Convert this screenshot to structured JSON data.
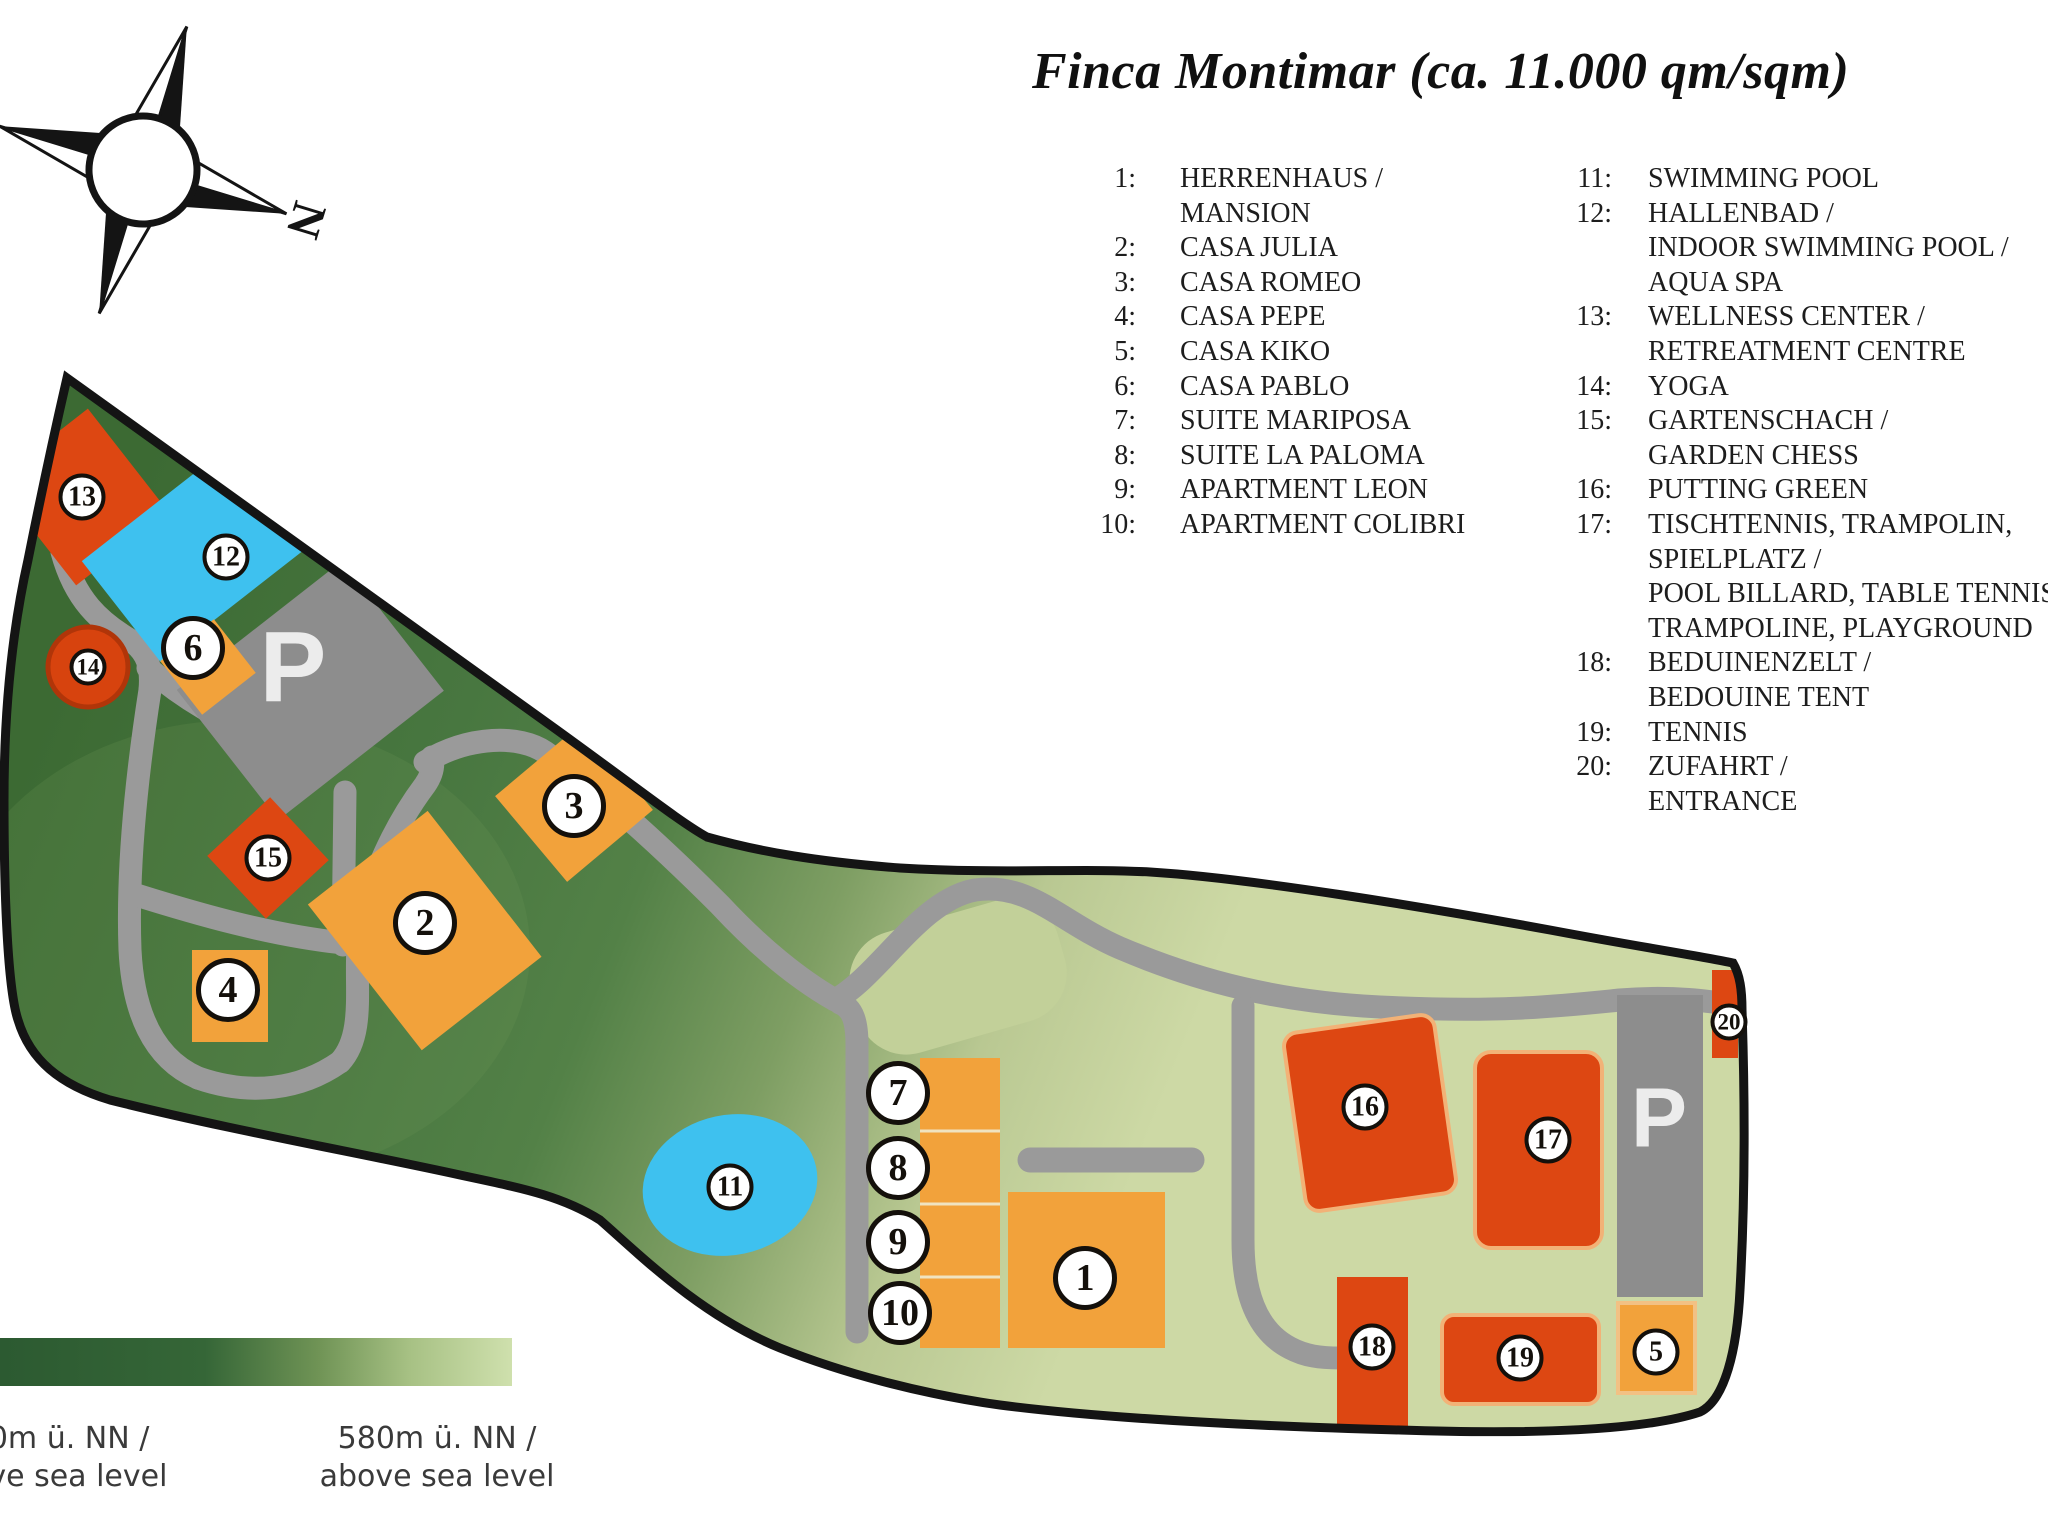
{
  "title": "Finca Montimar (ca. 11.000 qm/sqm)",
  "compass": {
    "north_label": "N"
  },
  "legend": {
    "col1": [
      {
        "num": "1:",
        "text": "HERRENHAUS /"
      },
      {
        "num": "",
        "text": "MANSION"
      },
      {
        "num": "2:",
        "text": "CASA JULIA"
      },
      {
        "num": "3:",
        "text": "CASA ROMEO"
      },
      {
        "num": "4:",
        "text": "CASA PEPE"
      },
      {
        "num": "5:",
        "text": "CASA KIKO"
      },
      {
        "num": "6:",
        "text": "CASA PABLO"
      },
      {
        "num": "7:",
        "text": "SUITE MARIPOSA"
      },
      {
        "num": "8:",
        "text": "SUITE LA PALOMA"
      },
      {
        "num": "9:",
        "text": "APARTMENT LEON"
      },
      {
        "num": "10:",
        "text": "APARTMENT COLIBRI"
      }
    ],
    "col2": [
      {
        "num": "11:",
        "text": "SWIMMING POOL"
      },
      {
        "num": "12:",
        "text": "HALLENBAD /"
      },
      {
        "num": "",
        "text": "INDOOR SWIMMING POOL /"
      },
      {
        "num": "",
        "text": "AQUA SPA"
      },
      {
        "num": "13:",
        "text": "WELLNESS CENTER /"
      },
      {
        "num": "",
        "text": "RETREATMENT CENTRE"
      },
      {
        "num": "14:",
        "text": "YOGA"
      },
      {
        "num": "15:",
        "text": "GARTENSCHACH /"
      },
      {
        "num": "",
        "text": "GARDEN CHESS"
      },
      {
        "num": "16:",
        "text": "PUTTING GREEN"
      },
      {
        "num": "17:",
        "text": "TISCHTENNIS, TRAMPOLIN,"
      },
      {
        "num": "",
        "text": "SPIELPLATZ /"
      },
      {
        "num": "",
        "text": "POOL BILLARD, TABLE TENNIS,"
      },
      {
        "num": "",
        "text": "TRAMPOLINE, PLAYGROUND"
      },
      {
        "num": "18:",
        "text": "BEDUINENZELT /"
      },
      {
        "num": "",
        "text": "BEDOUINE TENT"
      },
      {
        "num": "19:",
        "text": "TENNIS"
      },
      {
        "num": "20:",
        "text": "ZUFAHRT /"
      },
      {
        "num": "",
        "text": "ENTRANCE"
      }
    ]
  },
  "map": {
    "markers": [
      "1",
      "2",
      "3",
      "4",
      "5",
      "6",
      "7",
      "8",
      "9",
      "10",
      "11",
      "12",
      "13",
      "14",
      "15",
      "16",
      "17",
      "18",
      "19",
      "20"
    ],
    "parking_label": "P",
    "colors": {
      "land_dark_green": "#3c6a33",
      "land_light_green": "#cdd9a5",
      "building_orange": "#f2a23b",
      "building_red": "#dd4712",
      "water_blue": "#3ec1ef",
      "road_gray": "#9a9a9a",
      "parking_gray": "#8d8d8d",
      "outline_black": "#141414"
    }
  },
  "elevation_legend": {
    "left_line1": "650m ü. NN /",
    "left_line2": "above sea level",
    "right_line1": "580m ü. NN /",
    "right_line2": "above sea level"
  }
}
